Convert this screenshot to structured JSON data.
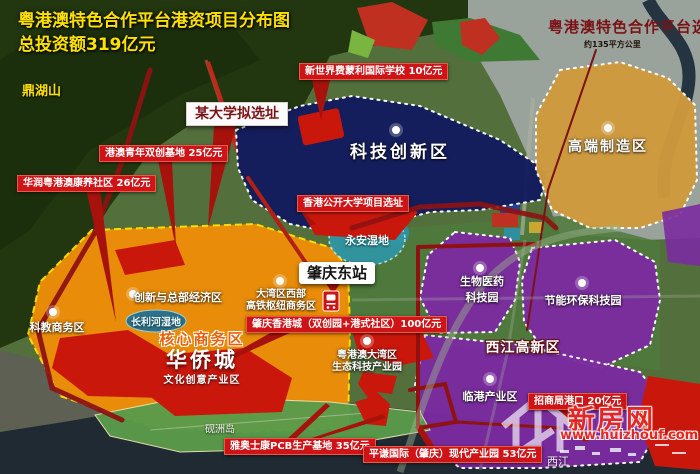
{
  "title": {
    "line1": "粤港澳特色合作平台港资项目分布图",
    "line2": "总投资额319亿元"
  },
  "corner": {
    "title": "粤港澳特色合作平台选址",
    "area_note": "约135平方公里"
  },
  "landmarks": {
    "mountain": "鼎湖山",
    "island": "砚洲岛",
    "river": "西江",
    "wetland_yongan": "永安湿地",
    "wetland_changli": "长利河湿地"
  },
  "station": {
    "name": "肇庆东站"
  },
  "zones": {
    "tech_innovation": "科技创新区",
    "high_end_manufacturing": "高端制造区",
    "biomedical_line1": "生物医药",
    "biomedical_line2": "科技园",
    "energy_env": "节能环保科技园",
    "port_industry": "临港产业区",
    "xijiang_hightech": "西江高新区",
    "innovation_hq": "创新与总部经济区",
    "science_edu_biz": "科教商务区",
    "hub_line1": "大湾区西部",
    "hub_line2": "高铁枢纽商务区",
    "eco_line1": "粤港澳大湾区",
    "eco_line2": "生态科技产业园",
    "core_business": "核心商务区",
    "oct_town": "华侨城",
    "cultural_industry": "文化创意产业区"
  },
  "projects": {
    "intl_school": "新世界费蒙利国际学校 10亿元",
    "youth_innovation_base": "港澳青年双创基地 25亿元",
    "cr_wellness_community": "华润粤港澳康养社区 26亿元",
    "hk_open_university": "香港公开大学项目选址",
    "university_site": "某大学拟选址",
    "hk_city": "肇庆香港城（双创园+港式社区）100亿元",
    "merchants_port": "招商局港口 20亿元",
    "pcb_base": "雅奥士康PCB生产基地 35亿元",
    "pingqian_park": "平谦国际（肇庆）现代产业园 53亿元"
  },
  "watermark": {
    "site_name": "新房网",
    "url": "www.huizhouf.com"
  },
  "colors": {
    "title_yellow": "#ffe100",
    "maroon": "#8e1212",
    "label_red": "#cf1418",
    "zone_navy": "#141c5e",
    "zone_gold": "#cf9a3d",
    "zone_orange": "#ef8e07",
    "zone_purple": "#7b2ba0",
    "wetland_teal": "#2f97a6",
    "red_patch": "#c9170c"
  }
}
